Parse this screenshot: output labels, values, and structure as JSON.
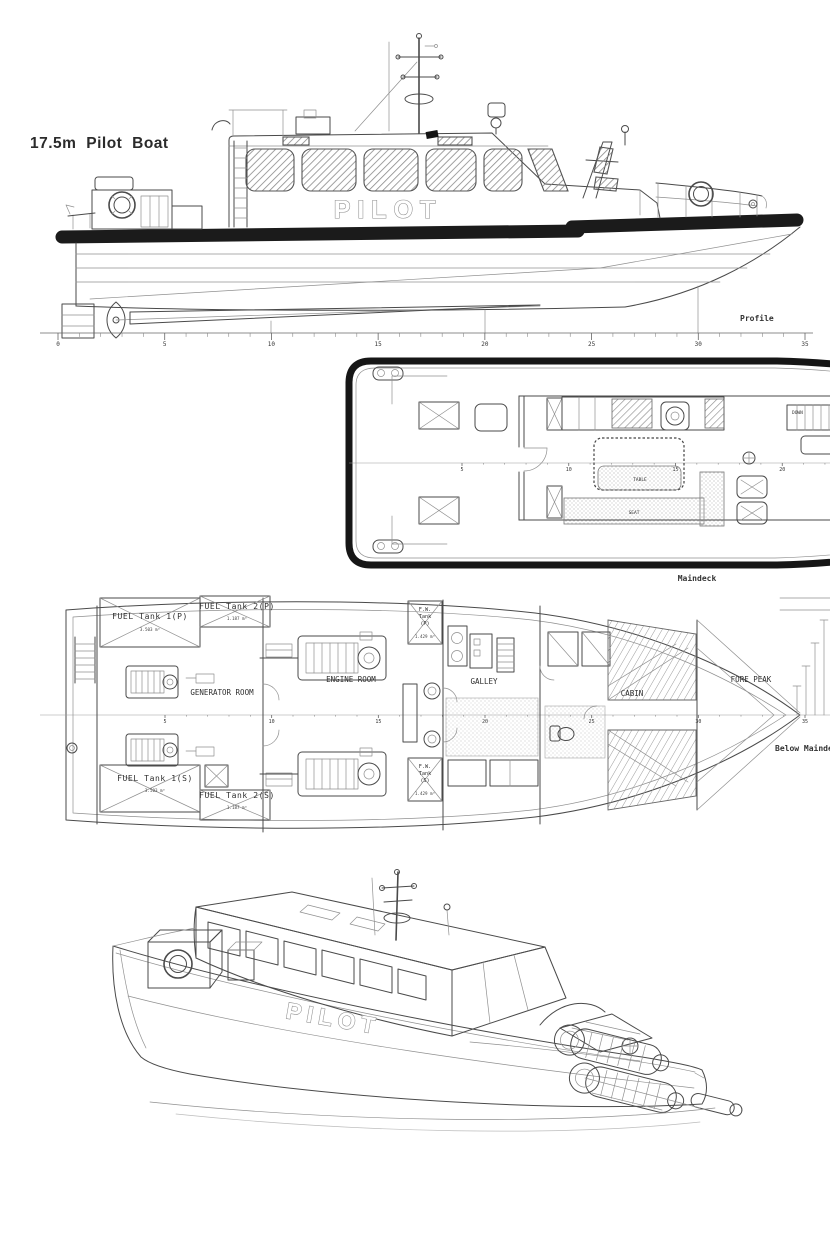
{
  "title": "17.5m Pilot Boat",
  "colors": {
    "outline": "#161616",
    "linework": "#4a4a4a",
    "background": "#ffffff"
  },
  "profile": {
    "label": "Profile",
    "boat_name": "PILOT",
    "ruler": {
      "x0": 58,
      "x1": 805,
      "y": 333,
      "tick": 7,
      "minor": 5,
      "font": 6,
      "baseline": true,
      "labels": [
        "0",
        "5",
        "10",
        "15",
        "20",
        "25",
        "30",
        "35"
      ]
    }
  },
  "maindeck": {
    "label": "Maindeck",
    "edge_label": "Maindeck",
    "table": "TABLE",
    "seat": "SEAT",
    "down": "DOWN",
    "ruler": {
      "x0": 165,
      "x1": 592,
      "y": 111,
      "tick": 3,
      "minor": 5,
      "font": 5,
      "baseline": false,
      "labels": [
        "5",
        "10",
        "15",
        "20",
        "25"
      ]
    }
  },
  "below": {
    "label": "Below Maindeck",
    "ruler": {
      "x0": 165,
      "x1": 805,
      "y": 127,
      "tick": 3,
      "minor": 5,
      "font": 5,
      "baseline": false,
      "labels": [
        "5",
        "10",
        "15",
        "20",
        "25",
        "30",
        "35"
      ]
    },
    "rooms": {
      "fuel1p": {
        "name": "FUEL Tank 1(P)",
        "vol": "3.503 m³"
      },
      "fuel2p": {
        "name": "FUEL Tank 2(P)",
        "vol": "1.187 m³"
      },
      "fuel1s": {
        "name": "FUEL Tank 1(S)",
        "vol": "3.503 m³"
      },
      "fuel2s": {
        "name": "FUEL Tank 2(S)",
        "vol": "1.187 m³"
      },
      "fwp": {
        "l1": "F.W.",
        "l2": "Tank",
        "l3": "(P)",
        "vol": "1.429 m³"
      },
      "fws": {
        "l1": "F.W.",
        "l2": "Tank",
        "l3": "(S)",
        "vol": "1.429 m³"
      },
      "generator_room": "GENERATOR ROOM",
      "engine_room": "ENGINE ROOM",
      "galley": "GALLEY",
      "cabin": "CABIN",
      "fore_peak": "FORE PEAK"
    }
  },
  "perspective": {
    "boat_name": "PILOT"
  }
}
